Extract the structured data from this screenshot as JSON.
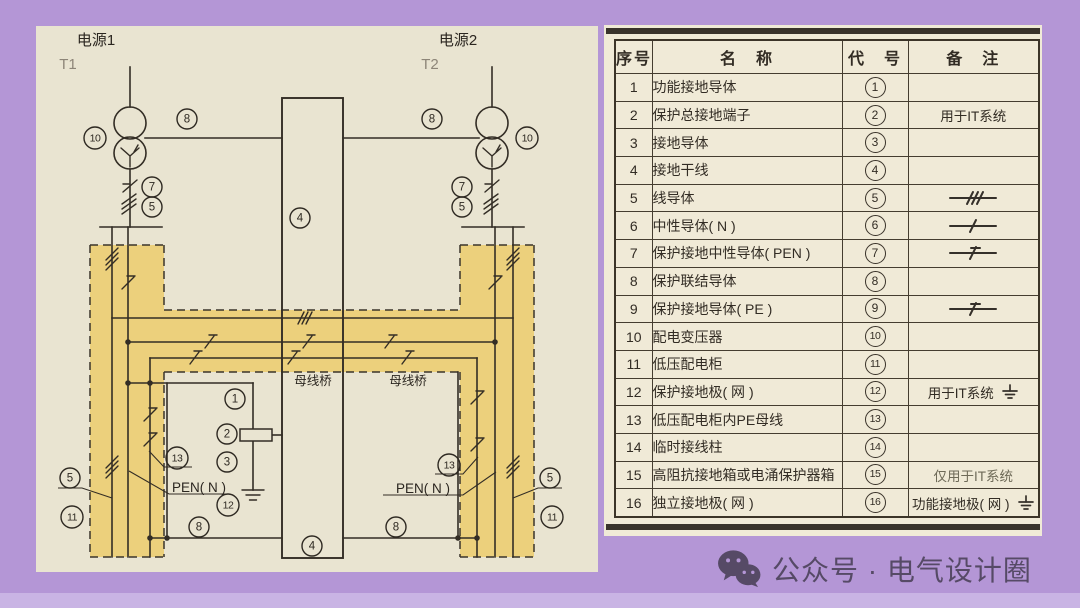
{
  "colors": {
    "background_purple": "#b496d6",
    "panel_beige": "#e9e4d1",
    "table_beige": "#f0ead7",
    "highlight_yellow": "#ecd07c",
    "line_dark": "#332d25"
  },
  "diagram": {
    "source1_label": "电源1",
    "source2_label": "电源2",
    "t1_label": "T1",
    "t2_label": "T2",
    "pen_label": "PEN( N )",
    "bus_bridge_label": "母线桥",
    "nums": {
      "1": "1",
      "2": "2",
      "3": "3",
      "4": "4",
      "5": "5",
      "7": "7",
      "8": "8",
      "10": "10",
      "11": "11",
      "12": "12",
      "13": "13"
    }
  },
  "table": {
    "headers": [
      "序号",
      "名　称",
      "代　号",
      "备　注"
    ],
    "rows": [
      {
        "no": "1",
        "name": "功能接地导体",
        "code": "1",
        "remark": "",
        "symbol": null,
        "muted": false
      },
      {
        "no": "2",
        "name": "保护总接地端子",
        "code": "2",
        "remark": "用于IT系统",
        "symbol": null,
        "muted": false
      },
      {
        "no": "3",
        "name": "接地导体",
        "code": "3",
        "remark": "",
        "symbol": null,
        "muted": false
      },
      {
        "no": "4",
        "name": "接地干线",
        "code": "4",
        "remark": "",
        "symbol": null,
        "muted": false
      },
      {
        "no": "5",
        "name": "线导体",
        "code": "5",
        "remark": "",
        "symbol": "three-slash-line",
        "muted": false
      },
      {
        "no": "6",
        "name": "中性导体( N )",
        "code": "6",
        "remark": "",
        "symbol": "slash-line",
        "muted": false
      },
      {
        "no": "7",
        "name": "保护接地中性导体( PEN )",
        "code": "7",
        "remark": "",
        "symbol": "pe-slash-line",
        "muted": false
      },
      {
        "no": "8",
        "name": "保护联结导体",
        "code": "8",
        "remark": "",
        "symbol": null,
        "muted": false
      },
      {
        "no": "9",
        "name": "保护接地导体( PE )",
        "code": "9",
        "remark": "",
        "symbol": "pe-slash-line",
        "muted": false
      },
      {
        "no": "10",
        "name": "配电变压器",
        "code": "10",
        "remark": "",
        "symbol": null,
        "muted": false
      },
      {
        "no": "11",
        "name": "低压配电柜",
        "code": "11",
        "remark": "",
        "symbol": null,
        "muted": false
      },
      {
        "no": "12",
        "name": "保护接地极( 网 )",
        "code": "12",
        "remark": "用于IT系统",
        "symbol": "earth-symbol",
        "muted": false
      },
      {
        "no": "13",
        "name": "低压配电柜内PE母线",
        "code": "13",
        "remark": "",
        "symbol": null,
        "muted": false
      },
      {
        "no": "14",
        "name": "临时接线柱",
        "code": "14",
        "remark": "",
        "symbol": null,
        "muted": false
      },
      {
        "no": "15",
        "name": "高阻抗接地箱或电涌保护器箱",
        "code": "15",
        "remark": "仅用于IT系统",
        "symbol": null,
        "muted": true
      },
      {
        "no": "16",
        "name": "独立接地极( 网 )",
        "code": "16",
        "remark": "功能接地极( 网 )",
        "symbol": "earth-symbol",
        "muted": false
      }
    ]
  },
  "watermark": {
    "icon": "wechat-icon",
    "text": "公众号 · 电气设计圈"
  }
}
